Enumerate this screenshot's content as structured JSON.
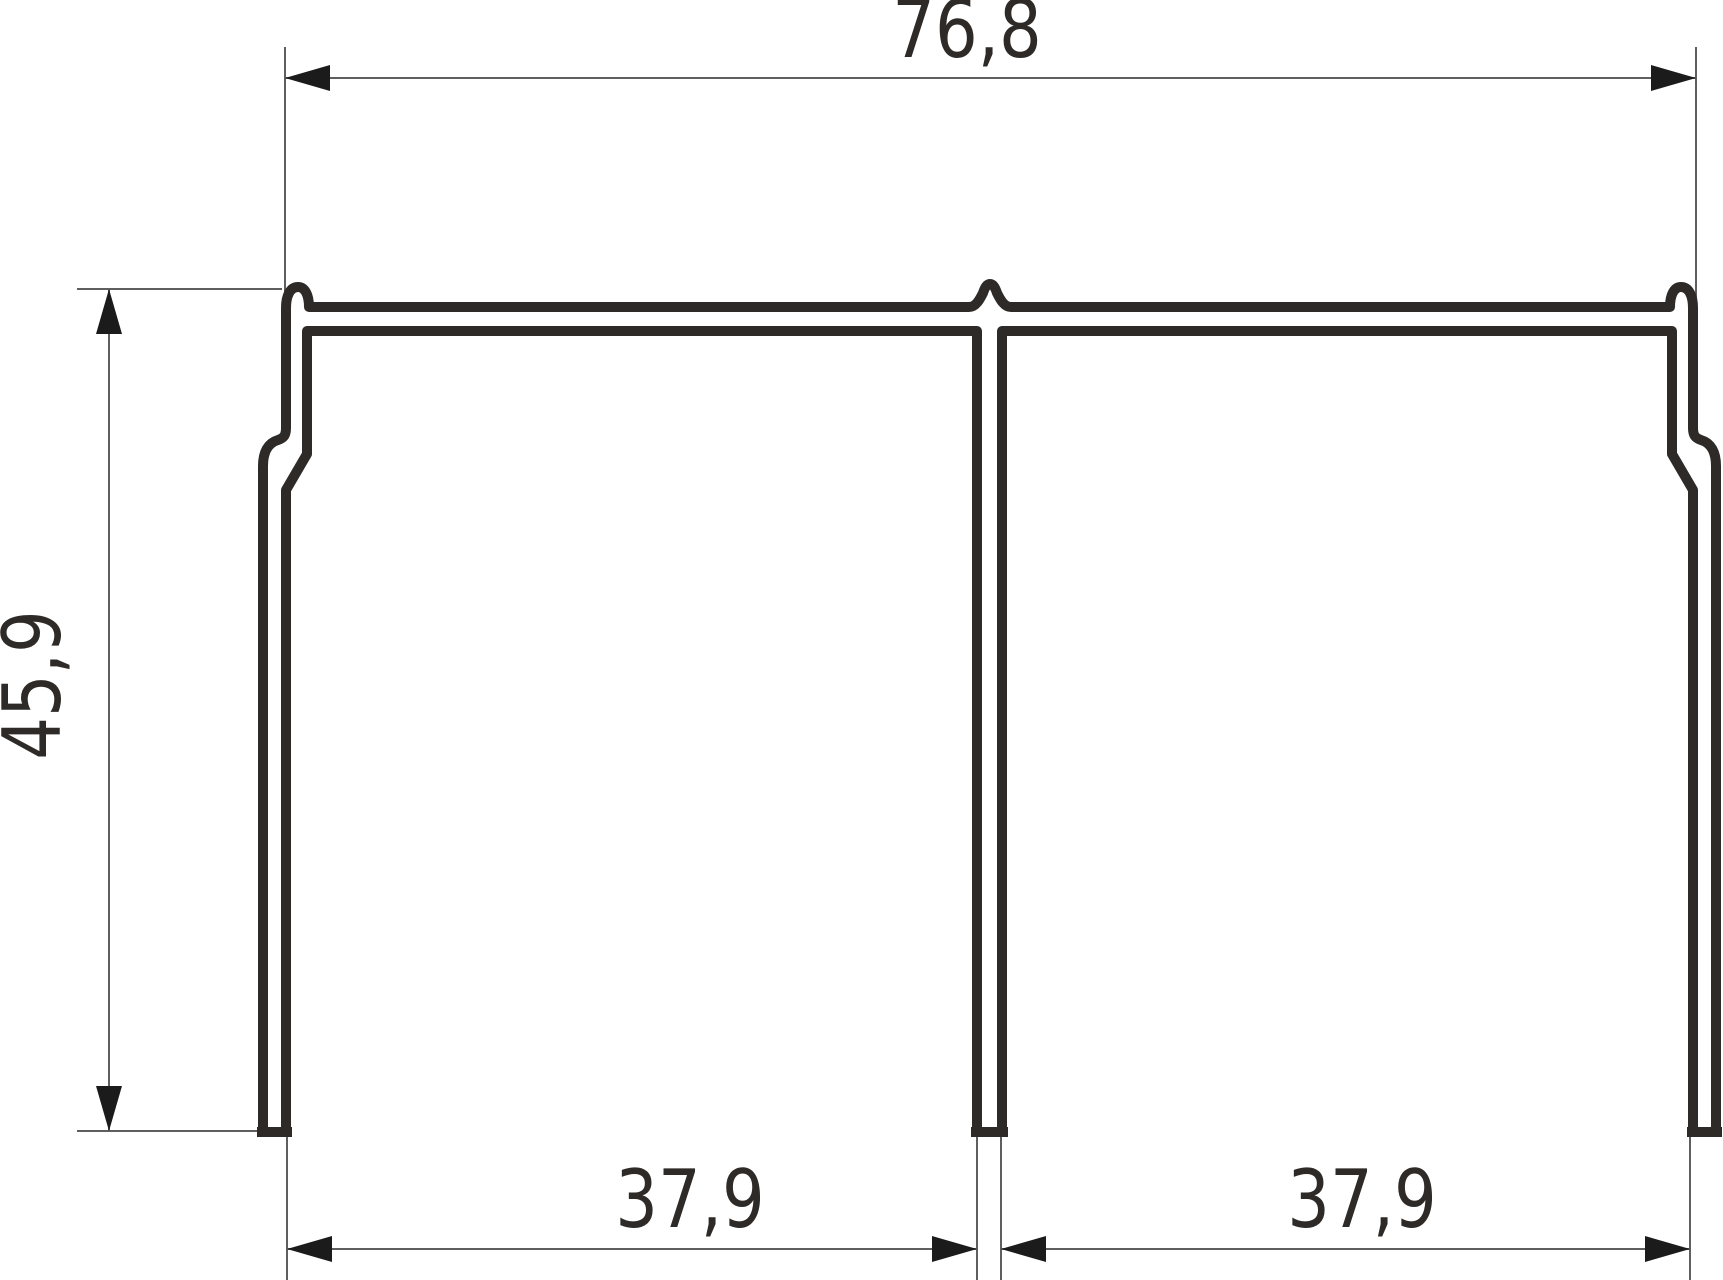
{
  "drawing": {
    "type": "profile-cross-section",
    "title": "aluminium double-channel track profile section",
    "dimensions": {
      "overall_width": "76,8",
      "overall_height": "45,9",
      "left_channel_width": "37,9",
      "right_channel_width": "37,9"
    },
    "colors": {
      "background": "#ffffff",
      "contour": "#2d2a27",
      "lines": "#5f5f5f",
      "arrow": "#1b1b1b",
      "text": "#2d2a27"
    }
  }
}
